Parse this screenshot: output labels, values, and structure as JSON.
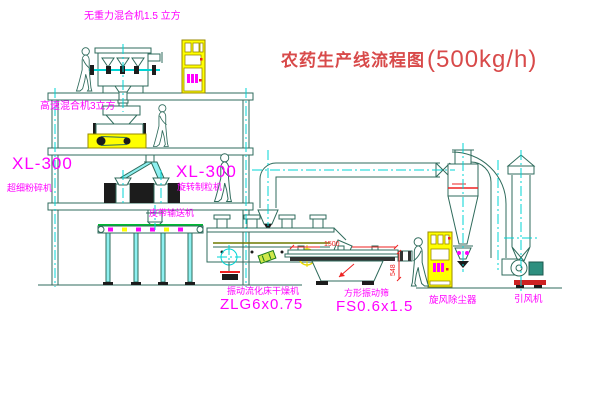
{
  "title": {
    "text": "农药生产线流程图",
    "capacity": "(500kg/h)"
  },
  "labels": {
    "top_mixer": "无重力混合机1.5 立方",
    "floor2_mixer": "高速混合机3立方",
    "mill_model": "XL-300",
    "mill_name": "超细粉碎机",
    "granulator_model": "XL-300",
    "granulator_name": "旋转制粒机",
    "belt_conveyor": "皮带输送机",
    "dryer_name": "振动流化床干燥机",
    "dryer_model": "ZLG6x0.75",
    "screen_name": "方形振动筛",
    "screen_model": "FS0.6x1.5",
    "cyclone_name": "旋风除尘器",
    "fan_name": "引风机"
  },
  "dimensions": {
    "screen_length": "1500",
    "screen_height": "548"
  },
  "colors": {
    "drawing_line": "#2f6b5c",
    "centerline_cyan": "#00d4d4",
    "label_magenta": "#ff00ff",
    "title_red": "#d84a4a",
    "dimension_red": "#ee2222",
    "highlight_yellow": "#ffff00",
    "belt_green": "#00bb33",
    "motor_teal": "#2e8f7f"
  },
  "icons": {
    "person_figure": "human-silhouette",
    "crosshair_target": "circle-crosshair",
    "cabinet_symbol": "magenta-motor-marks"
  }
}
